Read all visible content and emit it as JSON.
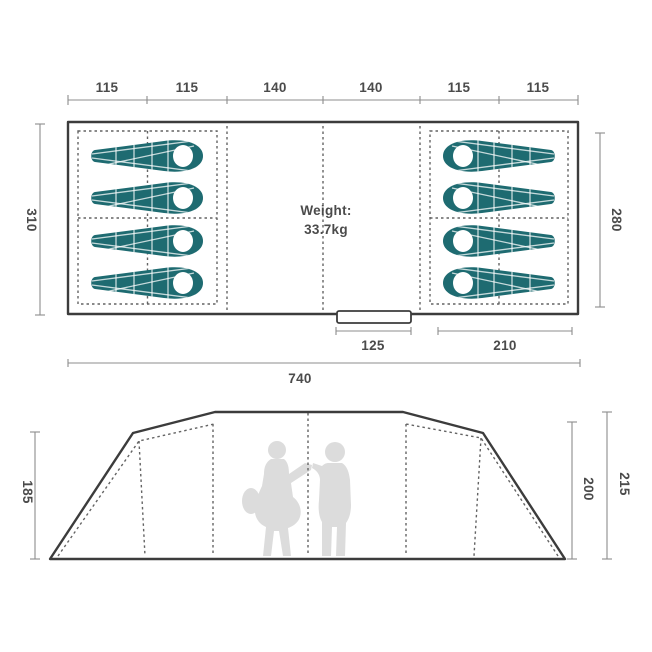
{
  "floor_plan": {
    "top_dims": [
      "115",
      "115",
      "140",
      "140",
      "115",
      "115"
    ],
    "left_depth": "310",
    "right_depth": "280",
    "door_width": "125",
    "front_width": "210",
    "total_width": "740",
    "weight_label": "Weight:",
    "weight_value": "33.7kg",
    "sleeping_bags_left": 4,
    "sleeping_bags_right": 4
  },
  "elevation": {
    "left_height": "185",
    "inner_height": "200",
    "total_height": "215",
    "people_count": 2
  },
  "colors": {
    "sleeping_bag_teal": "#1e6b71",
    "outline_dark": "#3c3c3c",
    "dimension_text": "#4b4b4b",
    "dashed_gray": "#636363",
    "silhouette_gray": "#dcdcdc"
  }
}
